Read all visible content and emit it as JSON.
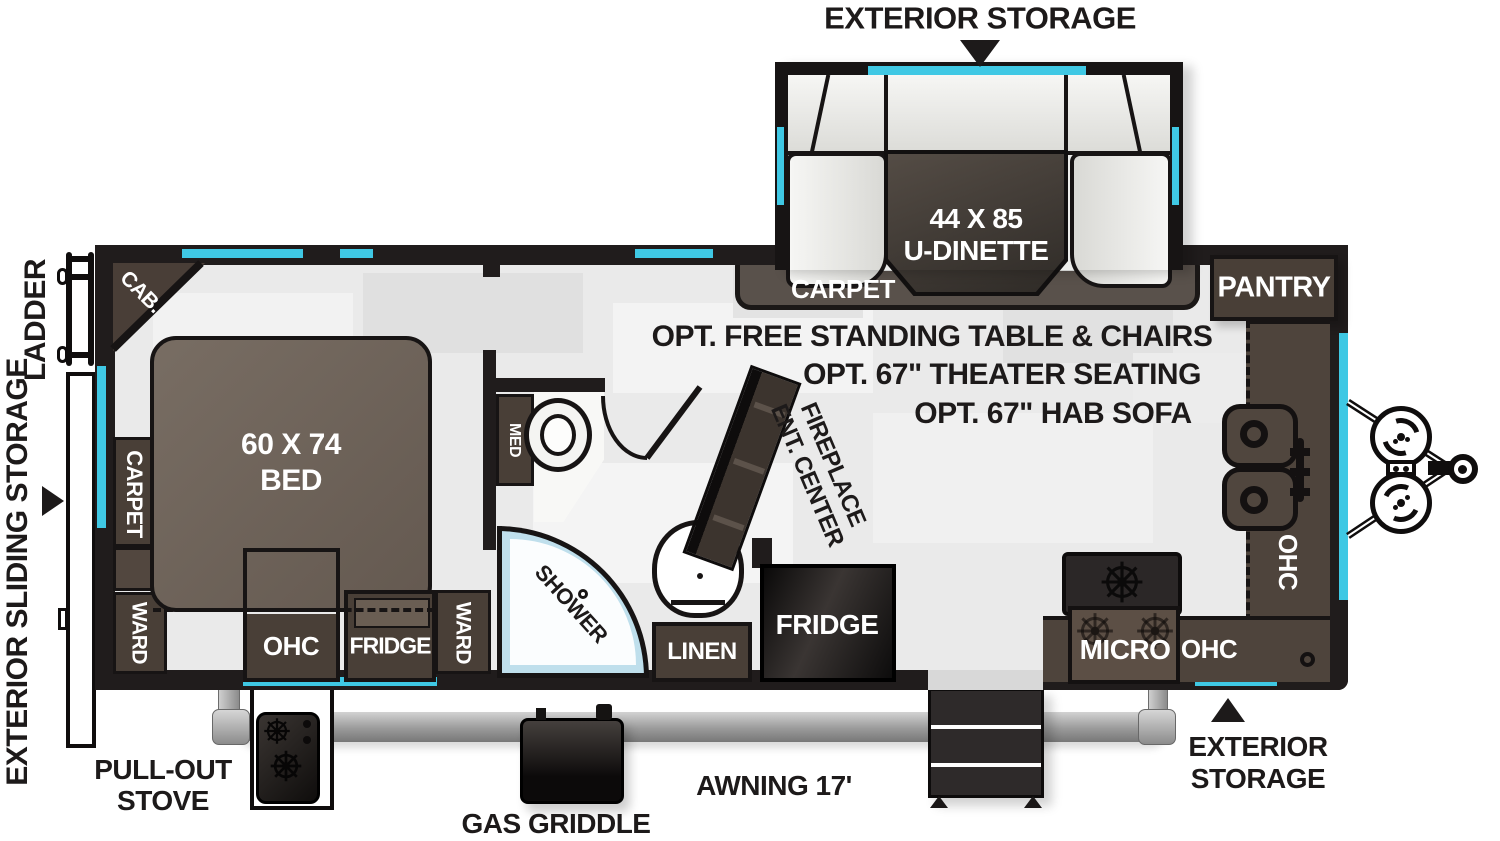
{
  "colors": {
    "wall": "#201c1c",
    "cabinet_brown": "#493f37",
    "counter_brown": "#4e443c",
    "bed_taupe": "#6e6359",
    "carpet": "#59514b",
    "floor": "#eaeaea",
    "window_cyan": "#3fc8e4",
    "shower_blue": "#cfe6f0",
    "ink": "#1d1a1a",
    "label_white": "#ffffff"
  },
  "exterior": {
    "storage_top": "EXTERIOR STORAGE",
    "storage_bottom_l1": "EXTERIOR",
    "storage_bottom_l2": "STORAGE",
    "ladder": "LADDER",
    "sliding_storage": "EXTERIOR SLIDING STORAGE",
    "pull_out_stove_l1": "PULL-OUT",
    "pull_out_stove_l2": "STOVE",
    "gas_griddle": "GAS GRIDDLE",
    "awning": "AWNING 17'"
  },
  "interior": {
    "dinette_l1": "44 X 85",
    "dinette_l2": "U-DINETTE",
    "carpet_slide": "CARPET",
    "pantry": "PANTRY",
    "options_l1": "OPT. FREE STANDING TABLE & CHAIRS",
    "options_l2": "OPT. 67\" THEATER SEATING",
    "options_l3": "OPT. 67\" HAB SOFA",
    "cab": "CAB.",
    "bed_l1": "60 X 74",
    "bed_l2": "BED",
    "carpet_bedroom": "CARPET",
    "ward_left": "WARD",
    "ward_right": "WARD",
    "ohc_bedroom": "OHC",
    "fridge_bedroom": "FRIDGE",
    "med": "MED",
    "shower": "SHOWER",
    "linen": "LINEN",
    "fireplace_l1": "FIREPLACE",
    "fireplace_l2": "ENT. CENTER",
    "fridge_main": "FRIDGE",
    "ohc_counter": "OHC",
    "micro": "MICRO",
    "ohc_kitchen": "OHC"
  }
}
